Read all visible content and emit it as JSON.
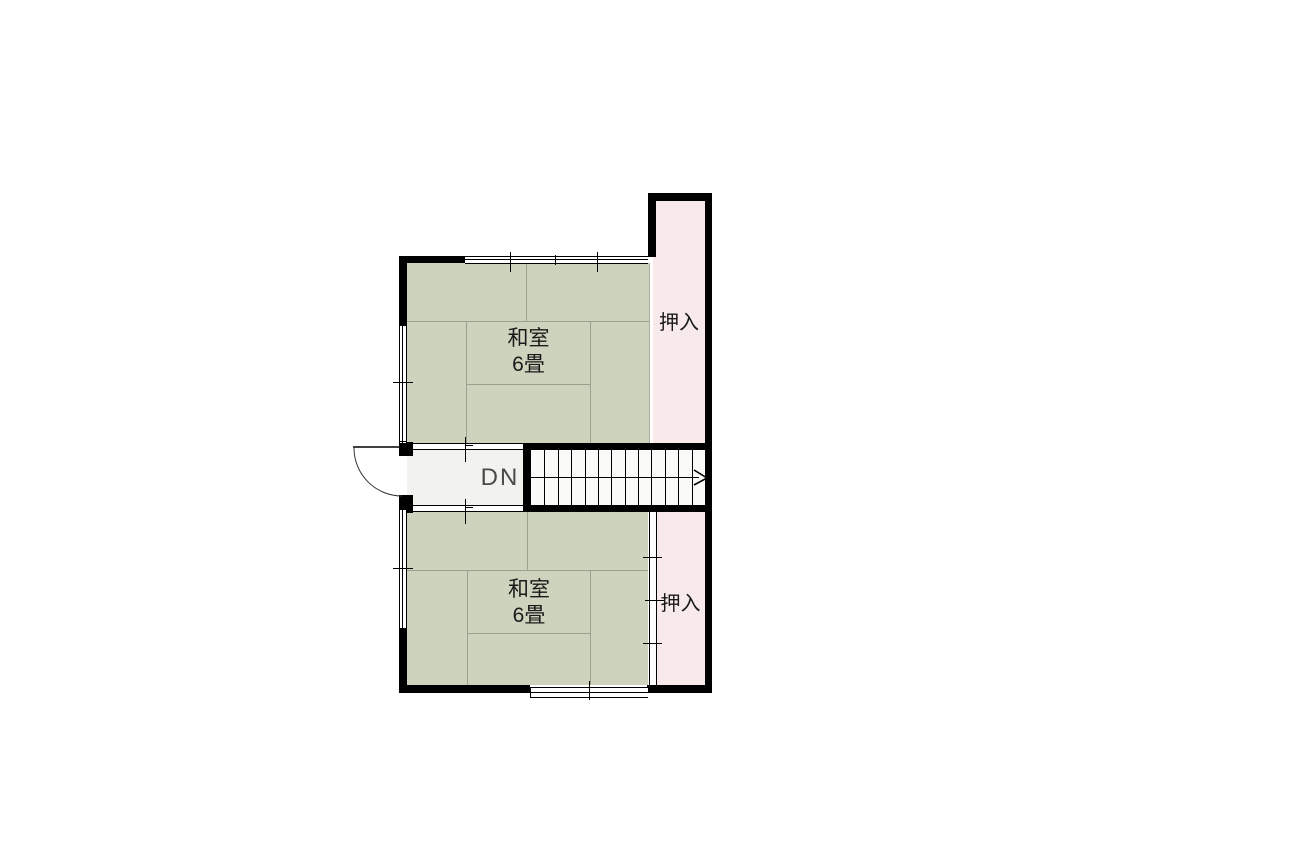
{
  "floorplan": {
    "rooms": [
      {
        "name": "和室",
        "size": "6畳"
      },
      {
        "name": "和室",
        "size": "6畳"
      }
    ],
    "closets": [
      {
        "label": "押入"
      },
      {
        "label": "押入"
      }
    ],
    "stairs": {
      "label": "DN",
      "tread_count": 12
    },
    "colors": {
      "wall": "#000000",
      "tatami": "#cdd3bd",
      "closet": "#f8e9ea",
      "hall": "#f2f2ef",
      "stair": "#fafaf8",
      "tatami_grid": "#9aa18f",
      "dn_text": "#4a4a4a",
      "label_text": "#1a1a1a"
    }
  }
}
